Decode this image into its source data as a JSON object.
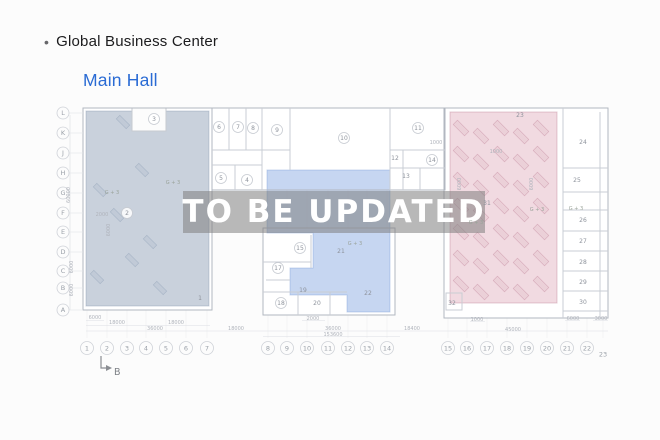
{
  "header": {
    "bullet": "•",
    "title": "Global Business Center",
    "subtitle": "Main Hall"
  },
  "watermark": {
    "text": "TO  BE UPDATED"
  },
  "colors": {
    "subtitle_blue": "#2a6bd4",
    "zone_left": "rgba(148,164,186,0.50)",
    "zone_mid": "rgba(128,164,224,0.45)",
    "zone_right": "rgba(216,148,170,0.35)",
    "watermark_band": "rgba(127,127,127,0.55)",
    "watermark_text": "#ffffff"
  },
  "plan": {
    "row_labels": [
      {
        "label": "L",
        "y": 113
      },
      {
        "label": "K",
        "y": 133
      },
      {
        "label": "J",
        "y": 153
      },
      {
        "label": "H",
        "y": 173
      },
      {
        "label": "G",
        "y": 193
      },
      {
        "label": "F",
        "y": 213
      },
      {
        "label": "E",
        "y": 232
      },
      {
        "label": "D",
        "y": 252
      },
      {
        "label": "C",
        "y": 271
      },
      {
        "label": "B",
        "y": 288
      },
      {
        "label": "A",
        "y": 310
      }
    ],
    "col_labels": [
      {
        "label": "1",
        "x": 87,
        "y": 348,
        "circle": true
      },
      {
        "label": "2",
        "x": 107,
        "y": 348,
        "circle": true
      },
      {
        "label": "3",
        "x": 127,
        "y": 348,
        "circle": true
      },
      {
        "label": "4",
        "x": 146,
        "y": 348,
        "circle": true
      },
      {
        "label": "5",
        "x": 166,
        "y": 348,
        "circle": true
      },
      {
        "label": "6",
        "x": 186,
        "y": 348,
        "circle": true
      },
      {
        "label": "7",
        "x": 207,
        "y": 348,
        "circle": true
      },
      {
        "label": "8",
        "x": 268,
        "y": 348,
        "circle": true
      },
      {
        "label": "9",
        "x": 287,
        "y": 348,
        "circle": true
      },
      {
        "label": "10",
        "x": 307,
        "y": 348,
        "circle": true
      },
      {
        "label": "11",
        "x": 328,
        "y": 348,
        "circle": true
      },
      {
        "label": "12",
        "x": 348,
        "y": 348,
        "circle": true
      },
      {
        "label": "13",
        "x": 367,
        "y": 348,
        "circle": true
      },
      {
        "label": "14",
        "x": 387,
        "y": 348,
        "circle": true
      },
      {
        "label": "15",
        "x": 448,
        "y": 348,
        "circle": true
      },
      {
        "label": "16",
        "x": 467,
        "y": 348,
        "circle": true
      },
      {
        "label": "17",
        "x": 487,
        "y": 348,
        "circle": true
      },
      {
        "label": "18",
        "x": 507,
        "y": 348,
        "circle": true
      },
      {
        "label": "19",
        "x": 527,
        "y": 348,
        "circle": true
      },
      {
        "label": "20",
        "x": 547,
        "y": 348,
        "circle": true
      },
      {
        "label": "21",
        "x": 567,
        "y": 348,
        "circle": true
      },
      {
        "label": "22",
        "x": 587,
        "y": 348,
        "circle": true
      },
      {
        "label": "23",
        "x": 603,
        "y": 354,
        "circle": false
      }
    ],
    "rooms": [
      {
        "n": "1",
        "x": 200,
        "y": 298,
        "c": false
      },
      {
        "n": "2",
        "x": 127,
        "y": 213,
        "c": true
      },
      {
        "n": "3",
        "x": 154,
        "y": 119,
        "c": true
      },
      {
        "n": "4",
        "x": 247,
        "y": 180,
        "c": true
      },
      {
        "n": "5",
        "x": 221,
        "y": 178,
        "c": true
      },
      {
        "n": "6",
        "x": 219,
        "y": 127,
        "c": true
      },
      {
        "n": "7",
        "x": 238,
        "y": 127,
        "c": true
      },
      {
        "n": "8",
        "x": 253,
        "y": 128,
        "c": true
      },
      {
        "n": "9",
        "x": 277,
        "y": 130,
        "c": true
      },
      {
        "n": "10",
        "x": 344,
        "y": 138,
        "c": true
      },
      {
        "n": "11",
        "x": 418,
        "y": 128,
        "c": true
      },
      {
        "n": "12",
        "x": 395,
        "y": 158,
        "c": false
      },
      {
        "n": "13",
        "x": 406,
        "y": 176,
        "c": false
      },
      {
        "n": "14",
        "x": 432,
        "y": 160,
        "c": true
      },
      {
        "n": "15",
        "x": 300,
        "y": 248,
        "c": true
      },
      {
        "n": "17",
        "x": 278,
        "y": 268,
        "c": true
      },
      {
        "n": "18",
        "x": 281,
        "y": 303,
        "c": true
      },
      {
        "n": "19",
        "x": 303,
        "y": 290,
        "c": false
      },
      {
        "n": "20",
        "x": 317,
        "y": 303,
        "c": false
      },
      {
        "n": "21",
        "x": 341,
        "y": 251,
        "c": false
      },
      {
        "n": "22",
        "x": 368,
        "y": 293,
        "c": false
      },
      {
        "n": "23",
        "x": 520,
        "y": 115,
        "c": false
      },
      {
        "n": "24",
        "x": 583,
        "y": 142,
        "c": false
      },
      {
        "n": "25",
        "x": 577,
        "y": 180,
        "c": false
      },
      {
        "n": "26",
        "x": 583,
        "y": 220,
        "c": false
      },
      {
        "n": "27",
        "x": 583,
        "y": 241,
        "c": false
      },
      {
        "n": "28",
        "x": 583,
        "y": 262,
        "c": false
      },
      {
        "n": "29",
        "x": 583,
        "y": 282,
        "c": false
      },
      {
        "n": "30",
        "x": 583,
        "y": 302,
        "c": false
      },
      {
        "n": "31",
        "x": 487,
        "y": 203,
        "c": false
      },
      {
        "n": "32",
        "x": 452,
        "y": 303,
        "c": false
      }
    ],
    "dims": [
      {
        "t": "6000",
        "x": 95,
        "y": 319
      },
      {
        "t": "2000",
        "x": 313,
        "y": 320
      },
      {
        "t": "1000",
        "x": 477,
        "y": 321
      },
      {
        "t": "6000",
        "x": 573,
        "y": 320
      },
      {
        "t": "3000",
        "x": 601,
        "y": 320
      },
      {
        "t": "18000",
        "x": 117,
        "y": 324
      },
      {
        "t": "18000",
        "x": 176,
        "y": 324
      },
      {
        "t": "36000",
        "x": 155,
        "y": 330
      },
      {
        "t": "18000",
        "x": 236,
        "y": 330
      },
      {
        "t": "36000",
        "x": 333,
        "y": 330
      },
      {
        "t": "18400",
        "x": 412,
        "y": 330
      },
      {
        "t": "45000",
        "x": 513,
        "y": 331
      },
      {
        "t": "153600",
        "x": 333,
        "y": 336
      },
      {
        "t": "1000",
        "x": 436,
        "y": 144
      },
      {
        "t": "1000",
        "x": 496,
        "y": 153
      },
      {
        "t": "2000",
        "x": 102,
        "y": 216
      },
      {
        "t": "60000",
        "x": 70,
        "y": 195,
        "rot": true
      },
      {
        "t": "6000",
        "x": 73,
        "y": 267,
        "rot": true
      },
      {
        "t": "6000",
        "x": 73,
        "y": 290,
        "rot": true
      },
      {
        "t": "6000",
        "x": 110,
        "y": 230,
        "rot": true
      },
      {
        "t": "6000",
        "x": 461,
        "y": 184,
        "rot": true
      },
      {
        "t": "6000",
        "x": 533,
        "y": 184,
        "rot": true
      }
    ],
    "zone_texts": [
      {
        "t": "G + 3",
        "x": 112,
        "y": 194
      },
      {
        "t": "G + 3",
        "x": 173,
        "y": 184
      },
      {
        "t": "G + 3",
        "x": 355,
        "y": 245
      },
      {
        "t": "G + 3",
        "x": 476,
        "y": 224
      },
      {
        "t": "G + 3",
        "x": 537,
        "y": 211
      },
      {
        "t": "G + 3",
        "x": 576,
        "y": 210
      }
    ],
    "section_marker": {
      "label": "B"
    }
  }
}
